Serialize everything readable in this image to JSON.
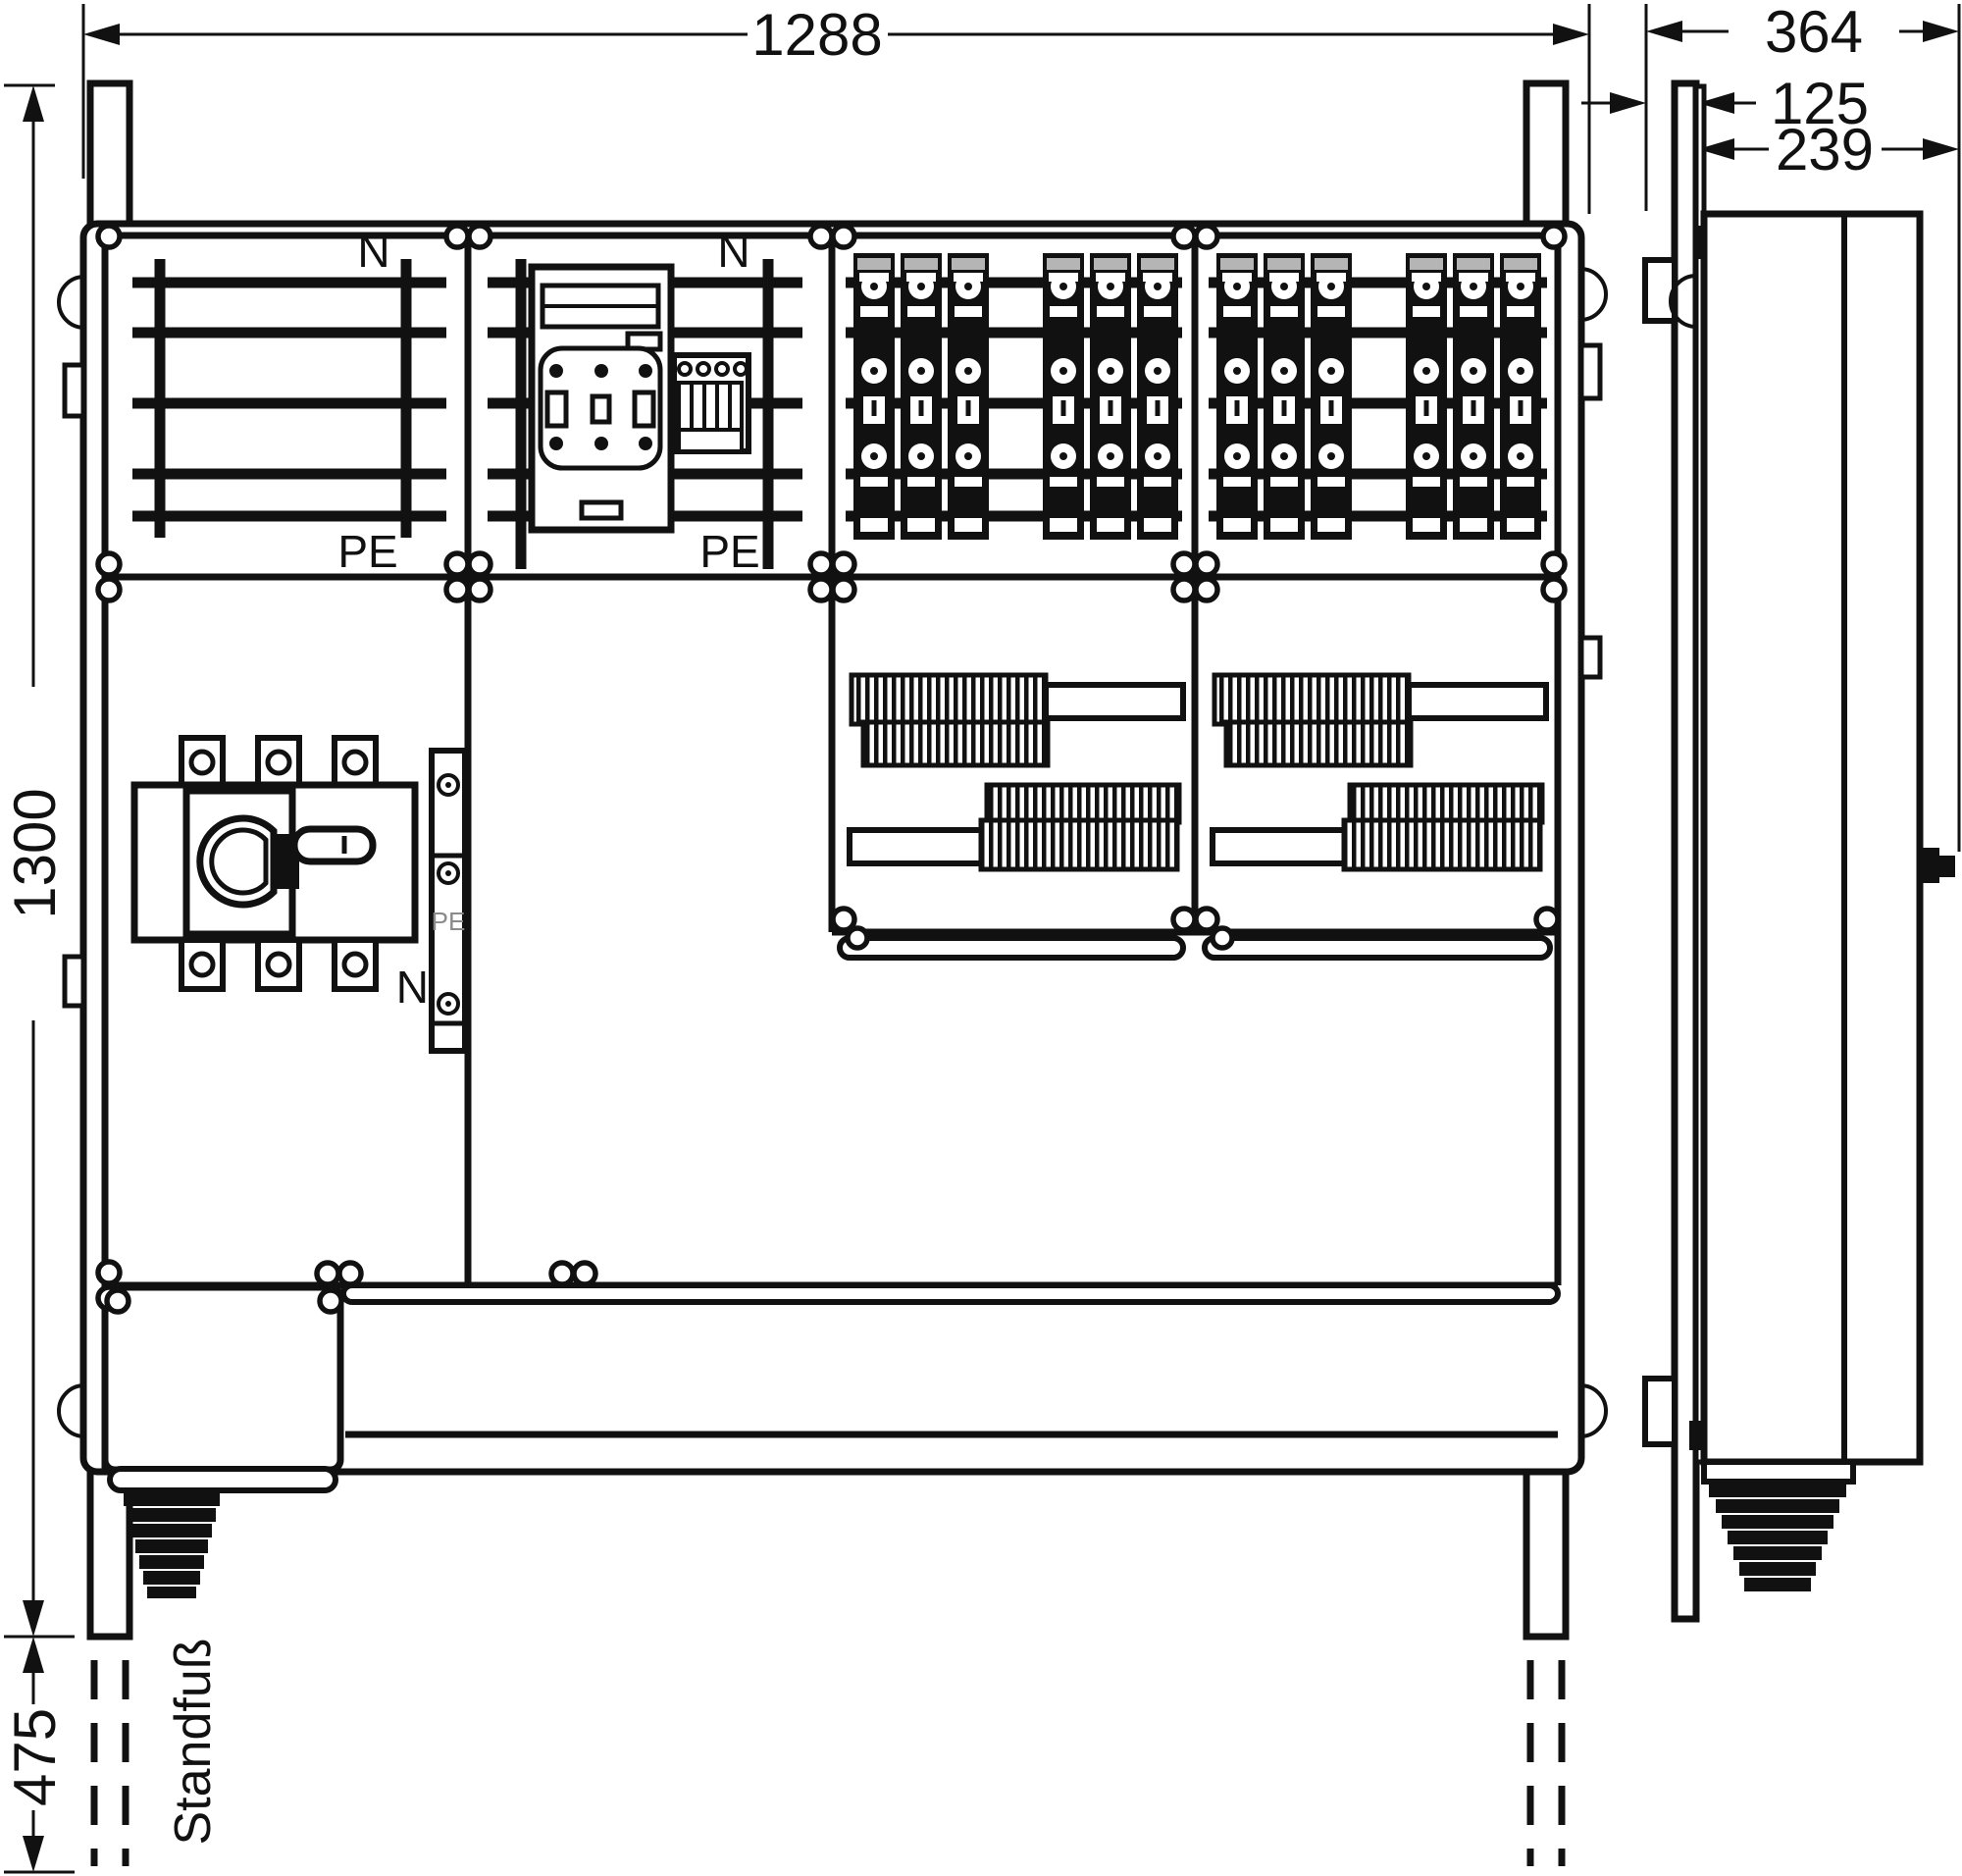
{
  "dimensions": {
    "width": "1288",
    "depth_total": "364",
    "depth_stand": "125",
    "depth_enclosure": "239",
    "height": "1300",
    "stand": "475"
  },
  "labels": {
    "stand": "Standfuß",
    "module1_n": "N",
    "module1_pe": "PE",
    "module2_n": "N",
    "module2_pe": "PE",
    "rail_pe": "PE",
    "rail_n": "N"
  },
  "colors": {
    "line": "#111111",
    "background": "#ffffff",
    "gray_text": "#8a8a8a"
  }
}
